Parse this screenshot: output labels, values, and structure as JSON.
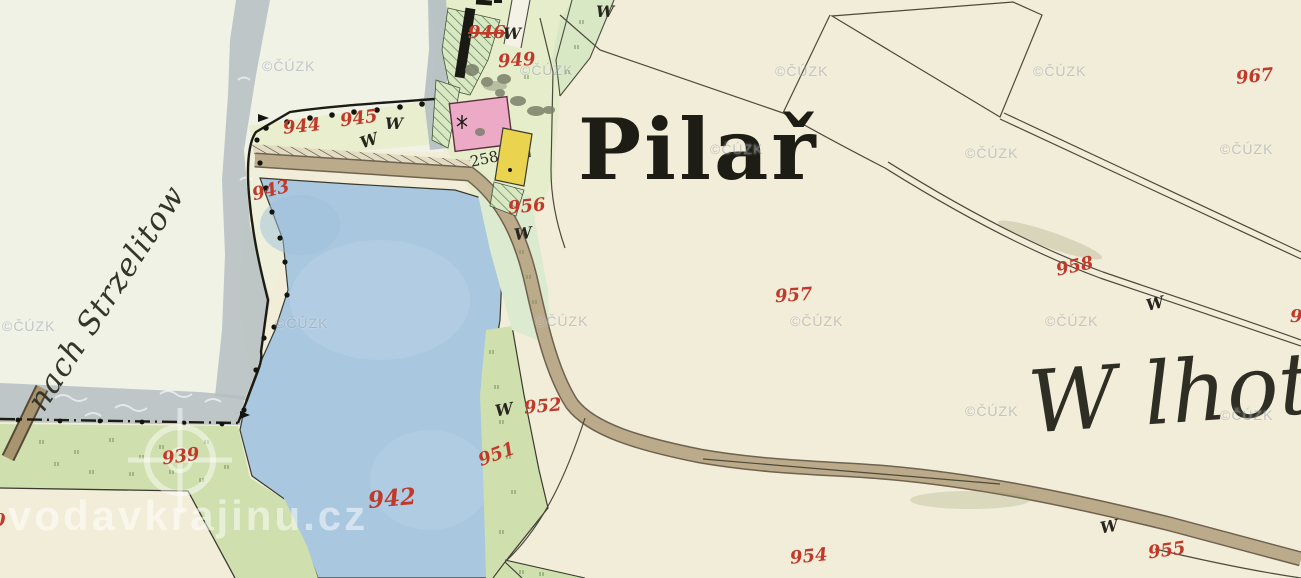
{
  "place_labels": {
    "village": "Pilař",
    "area_right": "W lhotka",
    "road_direction": "nach Strzelitow"
  },
  "parcel_numbers": {
    "n939": "939",
    "n942": "942",
    "n943": "943",
    "n944": "944",
    "n945": "945",
    "n946": "946",
    "n949": "949",
    "n951": "951",
    "n952": "952",
    "n954": "954",
    "n955": "955",
    "n956": "956",
    "n957": "957",
    "n958": "958",
    "n967": "967",
    "edge_left_partial": "0",
    "edge_right_partial": "9"
  },
  "house_numbers": {
    "h258": "258"
  },
  "symbols": {
    "meadow": "W"
  },
  "watermarks": {
    "cuzk": "©ČÚZK",
    "site": "vodavkrajinu.cz"
  },
  "colors": {
    "paper": "#f2edd8",
    "paper_pale": "#f0f2e6",
    "pond": "#a9c7df",
    "pond_light": "#bcd4e8",
    "water_grey": "#b5bec2",
    "meadow": "#cfe0ae",
    "garden_hatch": "#d9e8c4",
    "parcel_band": "#e9efce",
    "village_green": "#e6edcb",
    "road_fill": "#bcab8a",
    "road_edge": "#6e6250",
    "road_dark": "#a8946f",
    "building_pink": "#ecaac6",
    "building_yellow": "#ead34e",
    "annex_white": "#f6f3e4",
    "line": "#4c4a3c",
    "boundary": "#1c1c14",
    "number_red": "#c03a2b"
  }
}
